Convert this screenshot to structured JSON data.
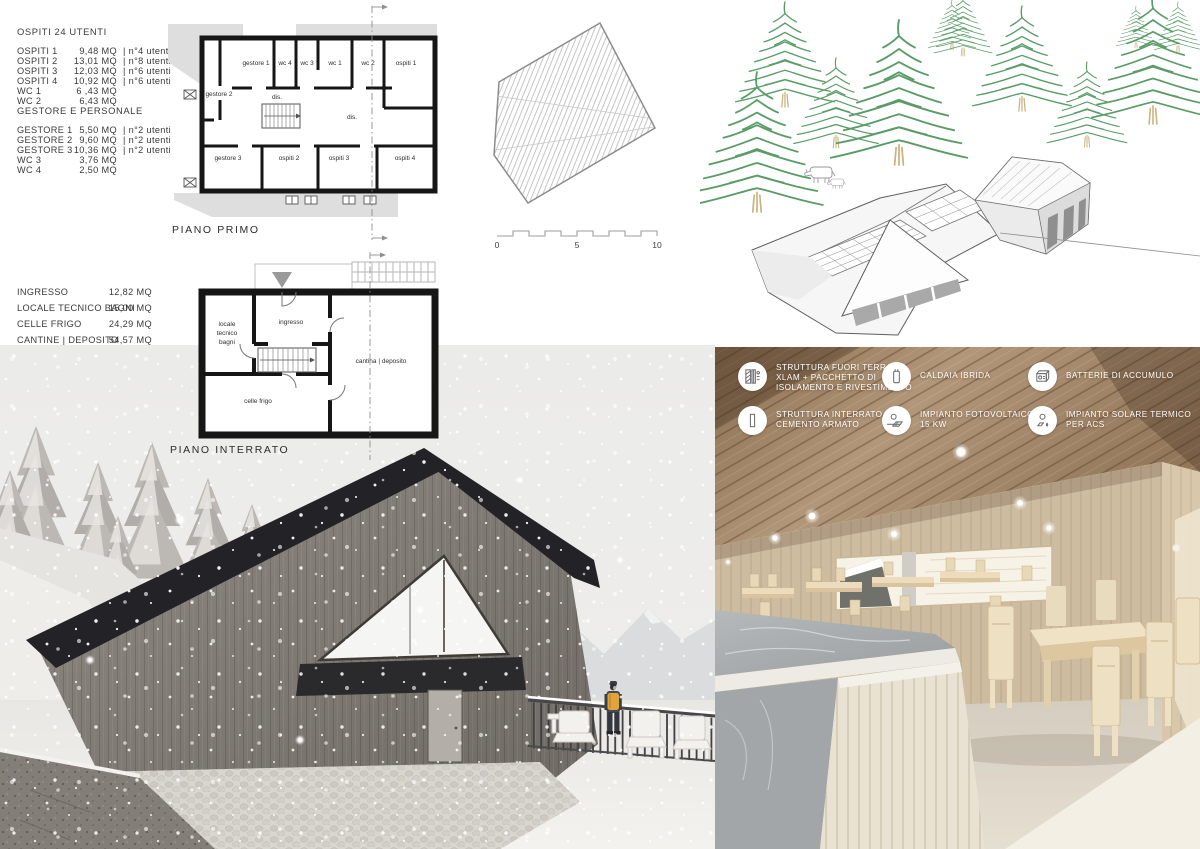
{
  "legend_ospiti": {
    "title": "OSPITI 24 UTENTI",
    "rows": [
      {
        "name": "OSPITI 1",
        "area": "9,48 MQ",
        "note": "| n°4 utenti"
      },
      {
        "name": "OSPITI 2",
        "area": "13,01 MQ",
        "note": "| n°8 utenti"
      },
      {
        "name": "OSPITI 3",
        "area": "12,03 MQ",
        "note": "| n°6 utenti"
      },
      {
        "name": "OSPITI 4",
        "area": "10,92 MQ",
        "note": "| n°6 utenti"
      },
      {
        "name": "WC 1",
        "area": "6 ,43 MQ",
        "note": ""
      },
      {
        "name": "WC 2",
        "area": "6,43  MQ",
        "note": ""
      }
    ]
  },
  "legend_gestore": {
    "title": "GESTORE E PERSONALE",
    "rows": [
      {
        "name": "GESTORE 1",
        "area": "5,50 MQ",
        "note": "| n°2 utenti"
      },
      {
        "name": "GESTORE 2",
        "area": "9,60 MQ",
        "note": "| n°2 utenti"
      },
      {
        "name": "GESTORE 3",
        "area": "10,36 MQ",
        "note": "| n°2 utenti"
      },
      {
        "name": "WC 3",
        "area": "3,76 MQ",
        "note": ""
      },
      {
        "name": "WC 4",
        "area": "2,50 MQ",
        "note": ""
      }
    ]
  },
  "legend_interrato": {
    "rows": [
      {
        "name": "INGRESSO",
        "area": "12,82 MQ"
      },
      {
        "name": "LOCALE TECNICO BAGNI",
        "area": "15,00 MQ"
      },
      {
        "name": "CELLE FRIGO",
        "area": "24,29 MQ"
      },
      {
        "name": "CANTINE | DEPOSITO",
        "area": "54,57 MQ"
      }
    ]
  },
  "plan_primo": {
    "label": "PIANO PRIMO",
    "rooms": {
      "gestore1": "gestore 1",
      "wc4": "wc 4",
      "wc3": "wc 3",
      "wc1": "wc 1",
      "wc2": "wc 2",
      "ospiti1": "ospiti 1",
      "gestore2": "gestore 2",
      "dis1": "dis.",
      "dis2": "dis.",
      "gestore3": "gestore 3",
      "ospiti2": "ospiti 2",
      "ospiti3": "ospiti 3",
      "ospiti4": "ospiti 4"
    }
  },
  "plan_interrato": {
    "label": "PIANO INTERRATO",
    "rooms": {
      "locale_l1": "locale",
      "locale_l2": "tecnico",
      "locale_l3": "bagni",
      "ingresso": "ingresso",
      "cantina": "cantina | deposito",
      "celle": "celle frigo"
    }
  },
  "scale_bar": {
    "labels": [
      "0",
      "5",
      "10"
    ]
  },
  "systems": {
    "items": [
      {
        "icon": "xlam-wall-icon",
        "lines": [
          "STRUTTURA FUORI TERRA",
          "XLAM + PACCHETTO DI",
          "ISOLAMENTO E RIVESTIMENTO"
        ]
      },
      {
        "icon": "hybrid-boiler-icon",
        "lines": [
          "CALDAIA IBRIDA"
        ]
      },
      {
        "icon": "storage-battery-icon",
        "lines": [
          "BATTERIE DI ACCUMULO"
        ]
      },
      {
        "icon": "reinforced-concrete-icon",
        "lines": [
          "STRUTTURA INTERRATO",
          "CEMENTO ARMATO"
        ]
      },
      {
        "icon": "photovoltaic-icon",
        "lines": [
          "IMPIANTO FOTOVOLTAICO",
          "15 KW"
        ]
      },
      {
        "icon": "solar-thermal-icon",
        "lines": [
          "IMPIANTO SOLARE TERMICO",
          "PER ACS"
        ]
      }
    ]
  },
  "colors": {
    "tree_green": "#5a9c68",
    "trunk_tan": "#c9b37e",
    "roof_dark": "#232327",
    "backpack_orange": "#e2a23c",
    "legend_text": "#3a3a3a",
    "overlay_text": "#ffffff"
  }
}
